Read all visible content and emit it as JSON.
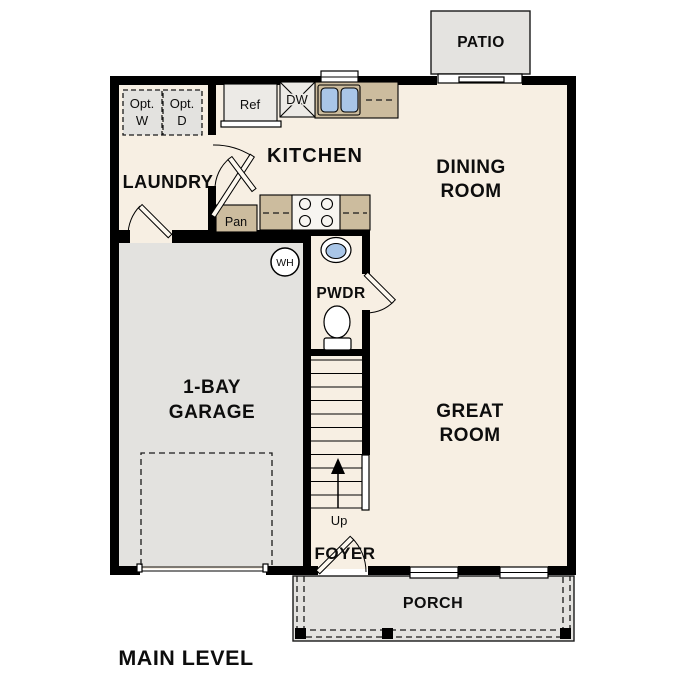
{
  "plan": {
    "title": "MAIN LEVEL"
  },
  "rooms": {
    "patio": "PATIO",
    "kitchen": "KITCHEN",
    "dining": {
      "line1": "DINING",
      "line2": "ROOM"
    },
    "laundry": "LAUNDRY",
    "garage": {
      "line1": "1-BAY",
      "line2": "GARAGE"
    },
    "great": {
      "line1": "GREAT",
      "line2": "ROOM"
    },
    "pwdr": "PWDR",
    "foyer": "FOYER",
    "porch": "PORCH"
  },
  "fixtures": {
    "ref": "Ref",
    "dw": "DW",
    "pan": "Pan",
    "wh": "WH",
    "up": "Up",
    "opt_w": {
      "line1": "Opt.",
      "line2": "W"
    },
    "opt_d": {
      "line1": "Opt.",
      "line2": "D"
    }
  },
  "colors": {
    "floor": "#f7efe3",
    "garage": "#e3e2df",
    "outdoor": "#e4e3e0",
    "counter": "#ccbc9e",
    "sinkblue": "#a9c6e8",
    "appliance": "#eceae6",
    "cooktop": "#f7f5f1",
    "wall": "#000000"
  }
}
